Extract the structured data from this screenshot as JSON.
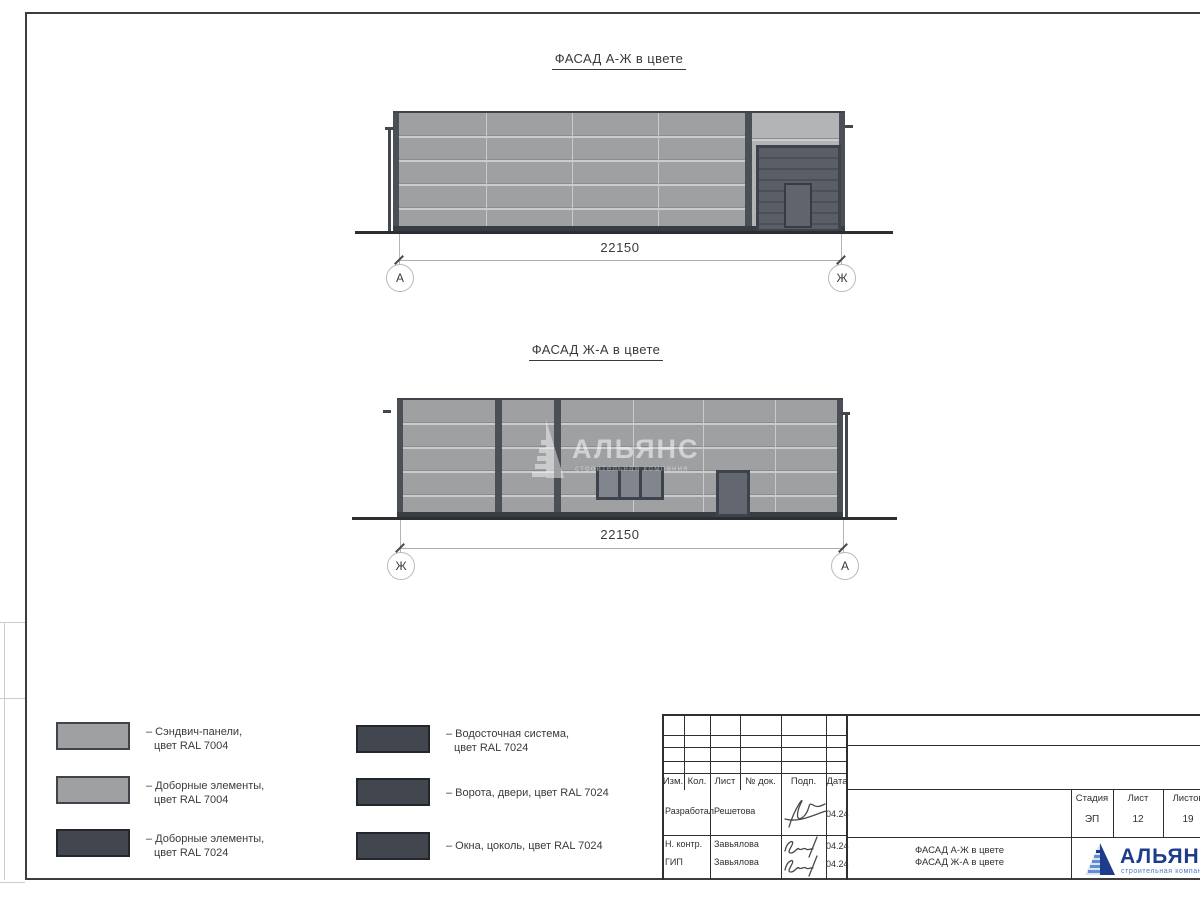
{
  "facades": [
    {
      "title": "ФАСАД А-Ж в цвете",
      "dimension": "22150",
      "axis_left": "А",
      "axis_right": "Ж"
    },
    {
      "title": "ФАСАД Ж-А в цвете",
      "dimension": "22150",
      "axis_left": "Ж",
      "axis_right": "А"
    }
  ],
  "watermark": {
    "name": "АЛЬЯНС",
    "subtitle": "строительная компания"
  },
  "legend": {
    "items": [
      {
        "swatch_color": "#9ea0a2",
        "lines": [
          "– Сэндвич-панели,",
          "цвет RAL 7004"
        ]
      },
      {
        "swatch_color": "#9ea0a2",
        "lines": [
          "– Доборные элементы,",
          "цвет RAL 7004"
        ]
      },
      {
        "swatch_color": "#42464f",
        "lines": [
          "– Доборные элементы,",
          "цвет RAL 7024"
        ]
      },
      {
        "swatch_color": "#42464f",
        "lines": [
          "– Водосточная система,",
          "цвет RAL 7024"
        ]
      },
      {
        "swatch_color": "#42464f",
        "lines": [
          "– Ворота, двери, цвет RAL 7024"
        ]
      },
      {
        "swatch_color": "#42464f",
        "lines": [
          "– Окна, цоколь, цвет RAL 7024"
        ]
      }
    ]
  },
  "title_block": {
    "revision_columns": [
      "Изм.",
      "Кол.",
      "Лист",
      "№ док.",
      "Подп.",
      "Дата"
    ],
    "signers": [
      {
        "role": "Разработал",
        "name": "Решетова",
        "date": "04.24"
      },
      {
        "role": "Н. контр.",
        "name": "Завьялова",
        "date": "04.24"
      },
      {
        "role": "ГИП",
        "name": "Завьялова",
        "date": "04.24"
      }
    ],
    "stage": {
      "label": "Стадия",
      "value": "ЭП"
    },
    "sheet": {
      "label": "Лист",
      "value": "12"
    },
    "sheets": {
      "label": "Листов",
      "value": "19"
    },
    "doc_title": [
      "ФАСАД А-Ж в цвете",
      "ФАСАД Ж-А в цвете"
    ],
    "company": {
      "name": "АЛЬЯНС",
      "subtitle": "строительная компания"
    }
  },
  "colors": {
    "panel_gray_ral7004": "#9ea0a2",
    "trim_light": "#b2b4b6",
    "dark_ral7024": "#42464f",
    "logo_blue": "#1e3c8c"
  }
}
